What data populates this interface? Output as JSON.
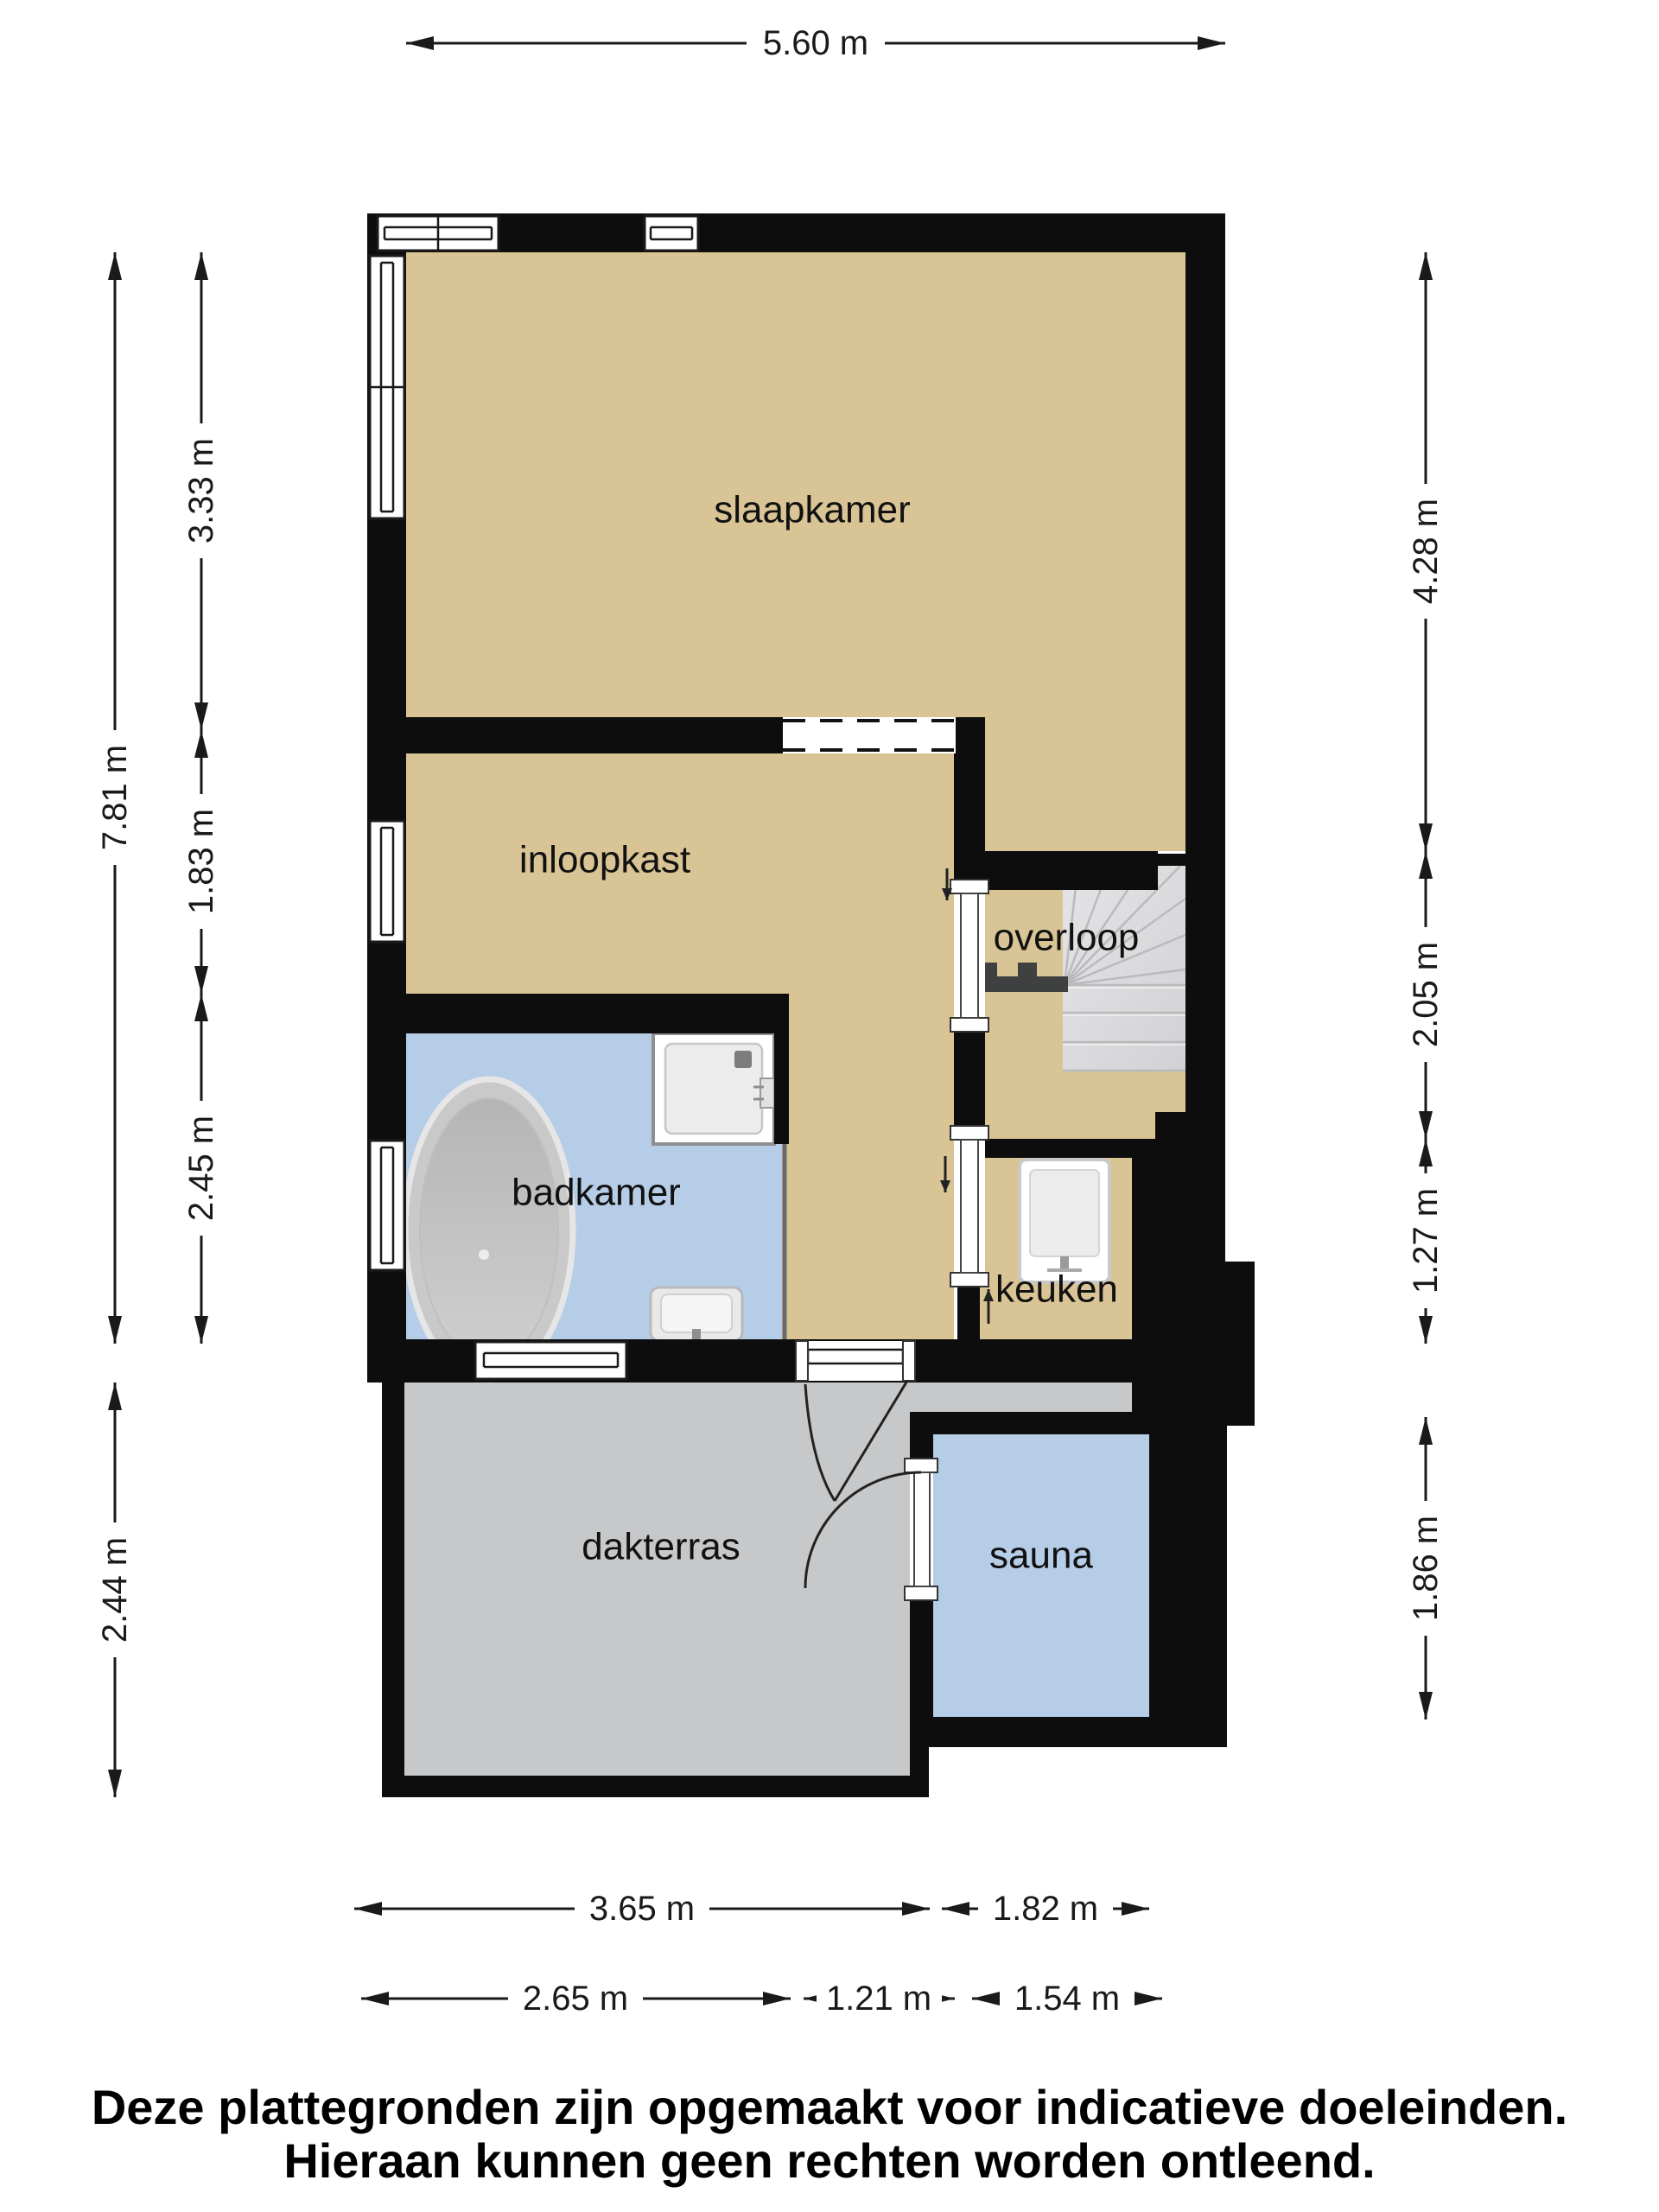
{
  "title": "floor-plan",
  "rooms": {
    "slaapkamer": {
      "label": "slaapkamer"
    },
    "inloopkast": {
      "label": "inloopkast"
    },
    "overloop": {
      "label": "overloop"
    },
    "badkamer": {
      "label": "badkamer"
    },
    "keuken": {
      "label": "keuken"
    },
    "dakterras": {
      "label": "dakterras"
    },
    "sauna": {
      "label": "sauna"
    }
  },
  "dimensions": {
    "top": "5.60 m",
    "left_total": "7.81 m",
    "left_lower": "2.44 m",
    "left_segments": [
      "3.33 m",
      "1.83 m",
      "2.45 m"
    ],
    "right_segments": [
      "4.28 m",
      "2.05 m",
      "1.27 m",
      "1.86 m"
    ],
    "bottom_row1": [
      "3.65 m",
      "1.82 m"
    ],
    "bottom_row2": [
      "2.65 m",
      "1.21 m",
      "1.54 m"
    ]
  },
  "disclaimer": {
    "line1": "Deze plattegronden zijn opgemaakt voor indicatieve doeleinden.",
    "line2": "Hieraan kunnen geen rechten worden ontleend."
  },
  "colors": {
    "floor": "#d9c495",
    "wet": "#b6cde7",
    "terrace": "#c6c8ca",
    "stairs": "#dbdbdd",
    "wall": "#0d0d0d"
  }
}
